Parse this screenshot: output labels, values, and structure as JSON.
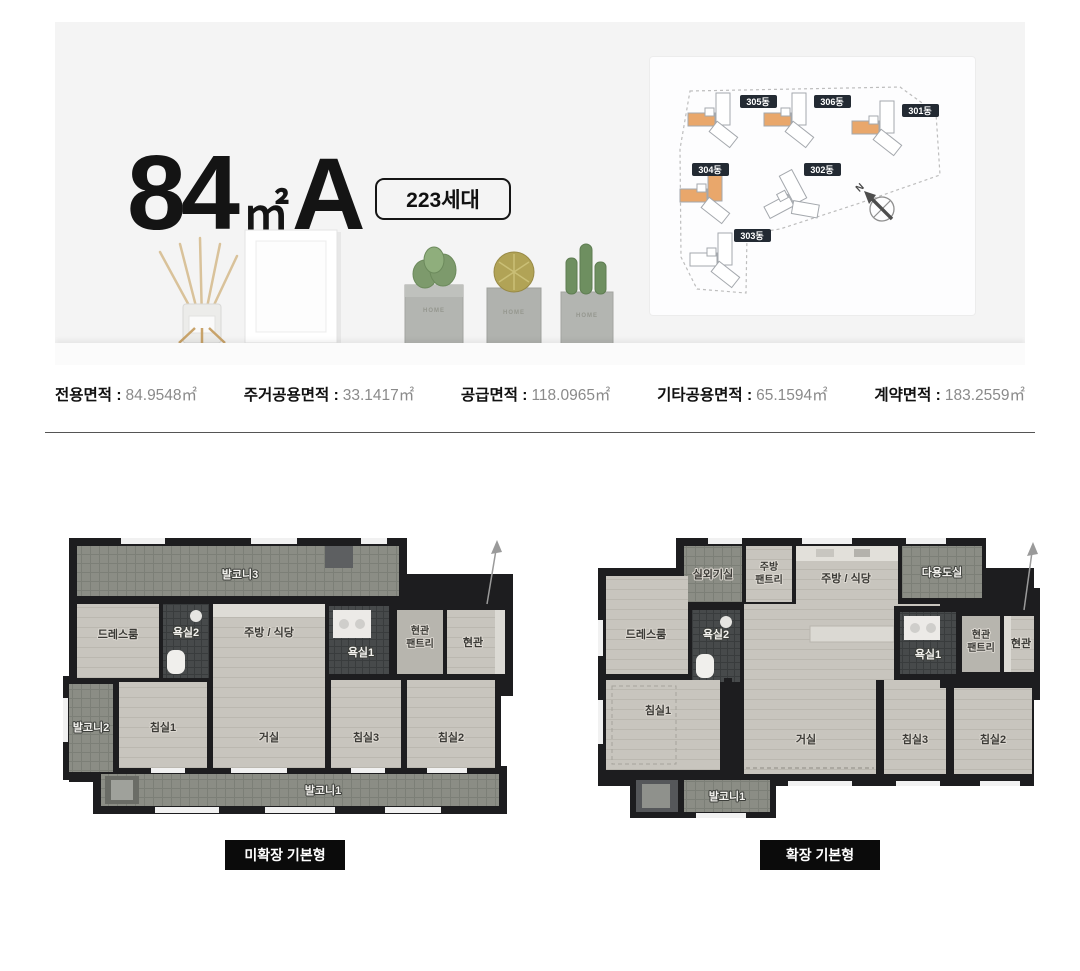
{
  "hero": {
    "title": {
      "number": "84",
      "unit": "㎡",
      "type": "A"
    },
    "badge": "223세대",
    "pot_label": "HOME"
  },
  "site_plan": {
    "compass_label": "N",
    "highlight_color": "#E9A76B",
    "buildings": [
      {
        "label": "305동",
        "highlighted": true
      },
      {
        "label": "306동",
        "highlighted": true
      },
      {
        "label": "301동",
        "highlighted": true
      },
      {
        "label": "304동",
        "highlighted": true
      },
      {
        "label": "302동",
        "highlighted": false
      },
      {
        "label": "303동",
        "highlighted": false
      }
    ]
  },
  "specs": [
    {
      "label": "전용면적 :",
      "value": "84.9548㎡"
    },
    {
      "label": "주거공용면적 :",
      "value": "33.1417㎡"
    },
    {
      "label": "공급면적 :",
      "value": "118.0965㎡"
    },
    {
      "label": "기타공용면적 :",
      "value": "65.1594㎡"
    },
    {
      "label": "계약면적 :",
      "value": "183.2559㎡"
    }
  ],
  "plans": [
    {
      "caption": "미확장 기본형",
      "rooms": {
        "balcony3": "발코니3",
        "dressroom": "드레스룸",
        "bath2": "욕실2",
        "kitchen": "주방 / 식당",
        "bath1": "욕실1",
        "entry_pantry_line1": "현관",
        "entry_pantry_line2": "팬트리",
        "entry": "현관",
        "balcony2": "발코니2",
        "bedroom1": "침실1",
        "living": "거실",
        "bedroom3": "침실3",
        "bedroom2": "침실2",
        "balcony1": "발코니1"
      }
    },
    {
      "caption": "확장 기본형",
      "rooms": {
        "ac_unit_room": "실외기실",
        "kitchen_pantry_line1": "주방",
        "kitchen_pantry_line2": "팬트리",
        "kitchen": "주방 / 식당",
        "utility": "다용도실",
        "dressroom": "드레스룸",
        "bath2": "욕실2",
        "bath1": "욕실1",
        "entry_pantry_line1": "현관",
        "entry_pantry_line2": "팬트리",
        "entry": "현관",
        "bedroom1": "침실1",
        "living": "거실",
        "bedroom3": "침실3",
        "bedroom2": "침실2",
        "balcony1": "발코니1"
      }
    }
  ],
  "colors": {
    "hero_bg": "#F4F4F4",
    "wall": "#1D1D1F",
    "room_floor": "#C8C5BE",
    "balcony_floor": "#8B8D85",
    "highlight_orange": "#E9A76B",
    "button_bg": "#0B0B0B"
  }
}
